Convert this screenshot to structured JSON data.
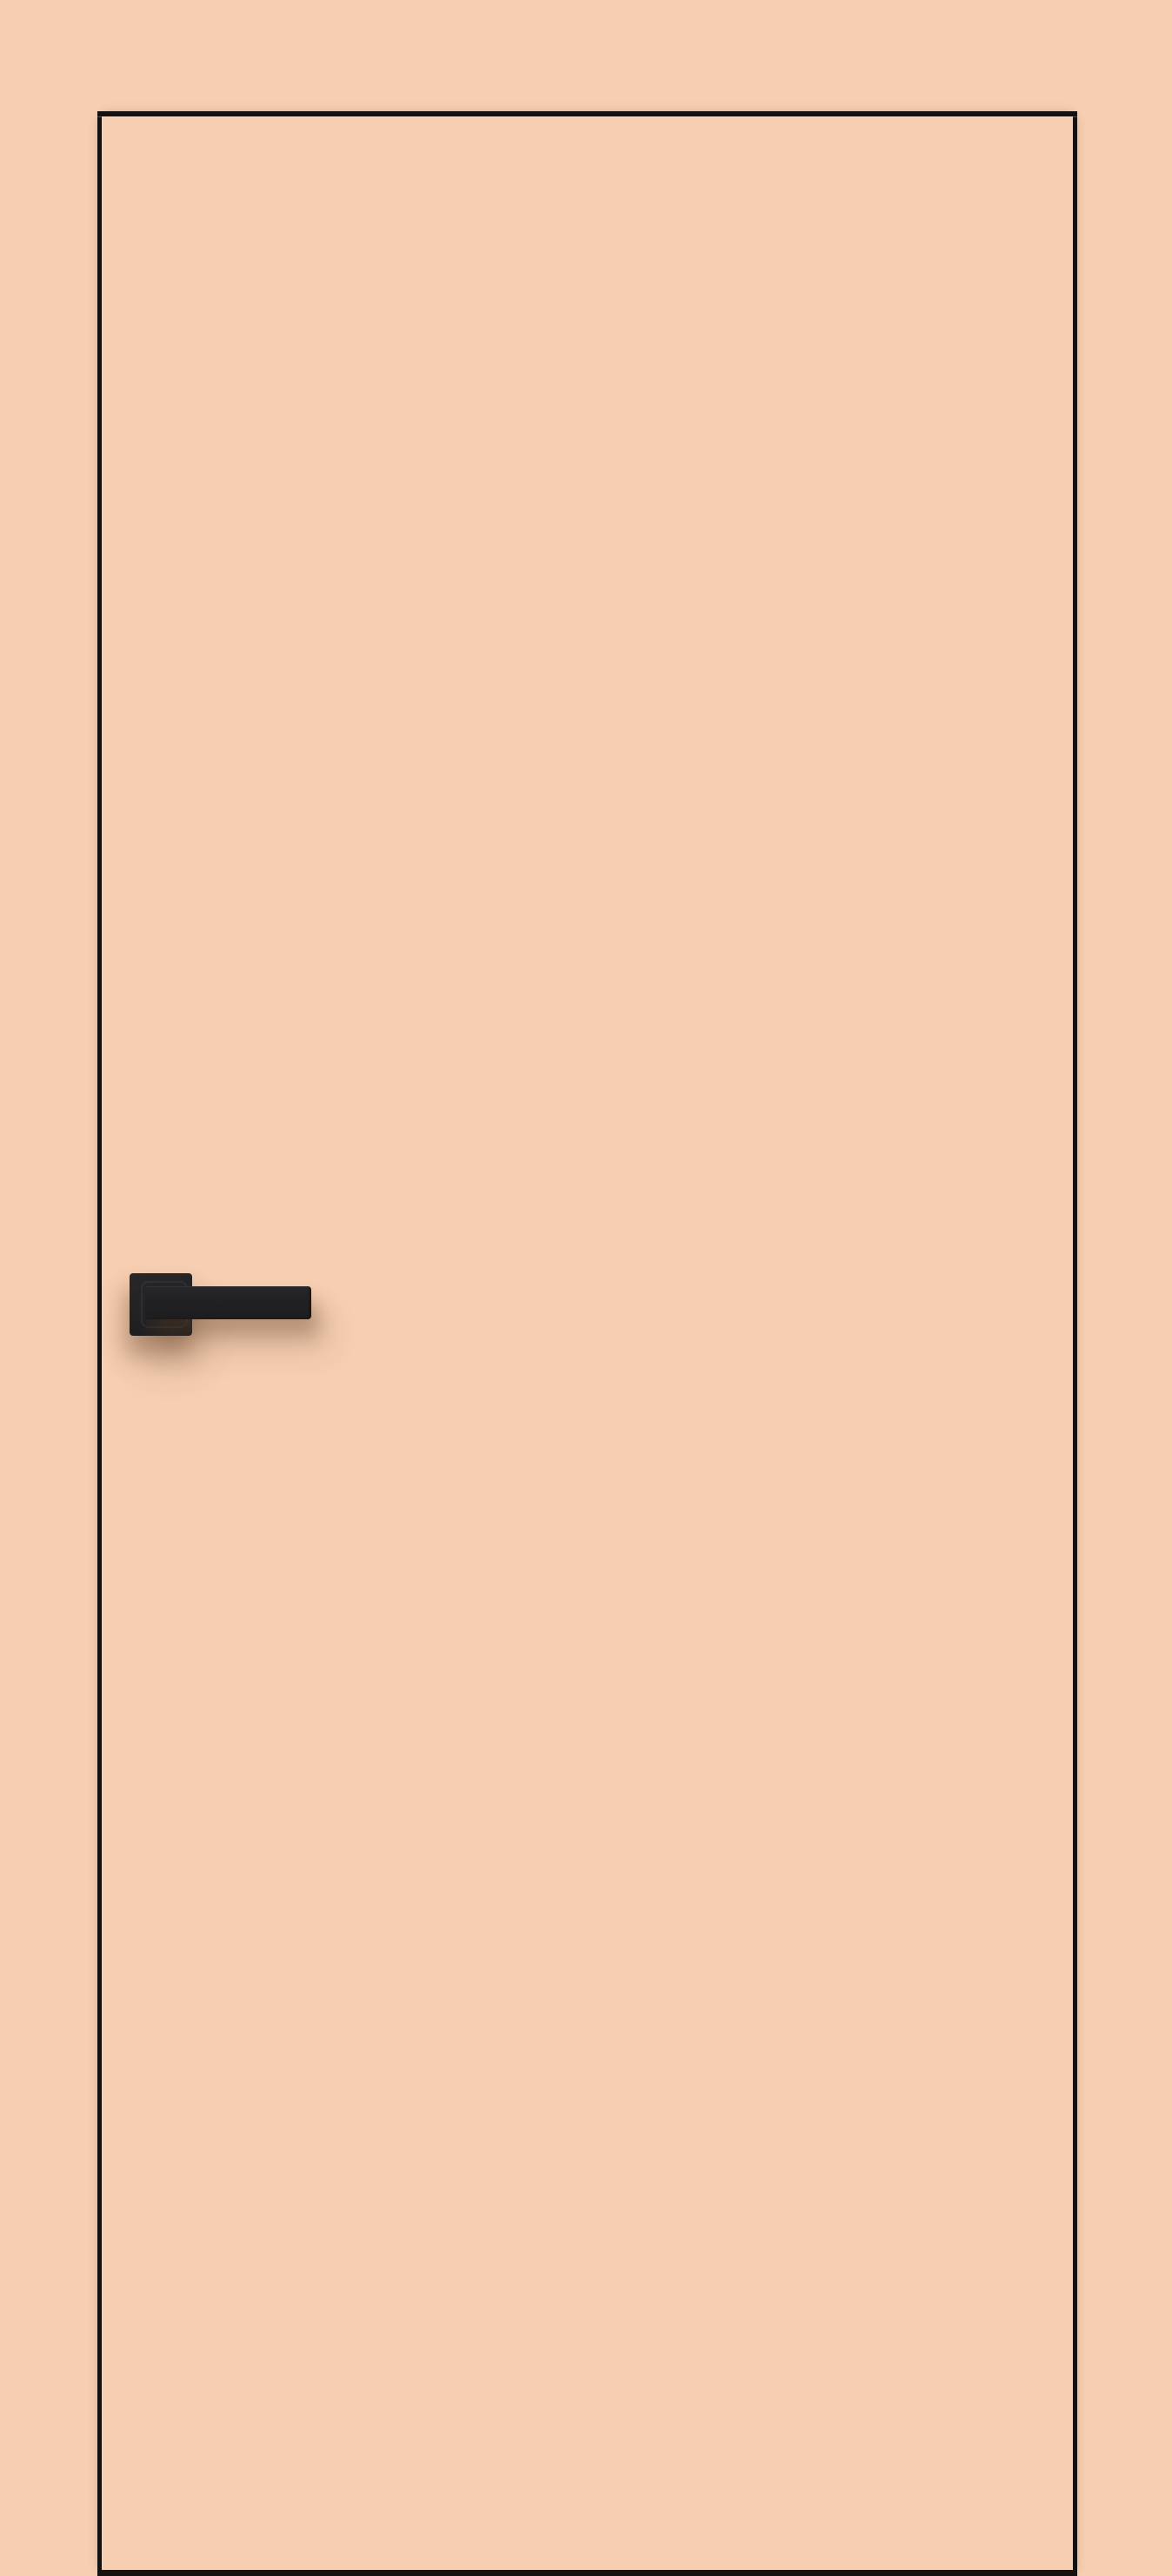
{
  "image": {
    "kind": "product-photo",
    "subject": "closed flush interior door, front view",
    "objects": {
      "door_leaf": "flush door panel with dark edge trim on top, left, right and bottom edges",
      "door_handle": "matte black lever handle on square rosette, mounted left side at mid height, lever pointing right"
    },
    "text_content": [],
    "colors": {
      "background": "#f6ceb1",
      "door_face": "#f6ceb1",
      "edge_trim": "#141110",
      "handle_dark": "#1d1d1f",
      "handle_mid": "#28282b",
      "handle_light": "#333336",
      "shadow_soft": "rgba(94,62,40,0.35)",
      "shadow_faint": "rgba(94,62,40,0.16)"
    }
  }
}
